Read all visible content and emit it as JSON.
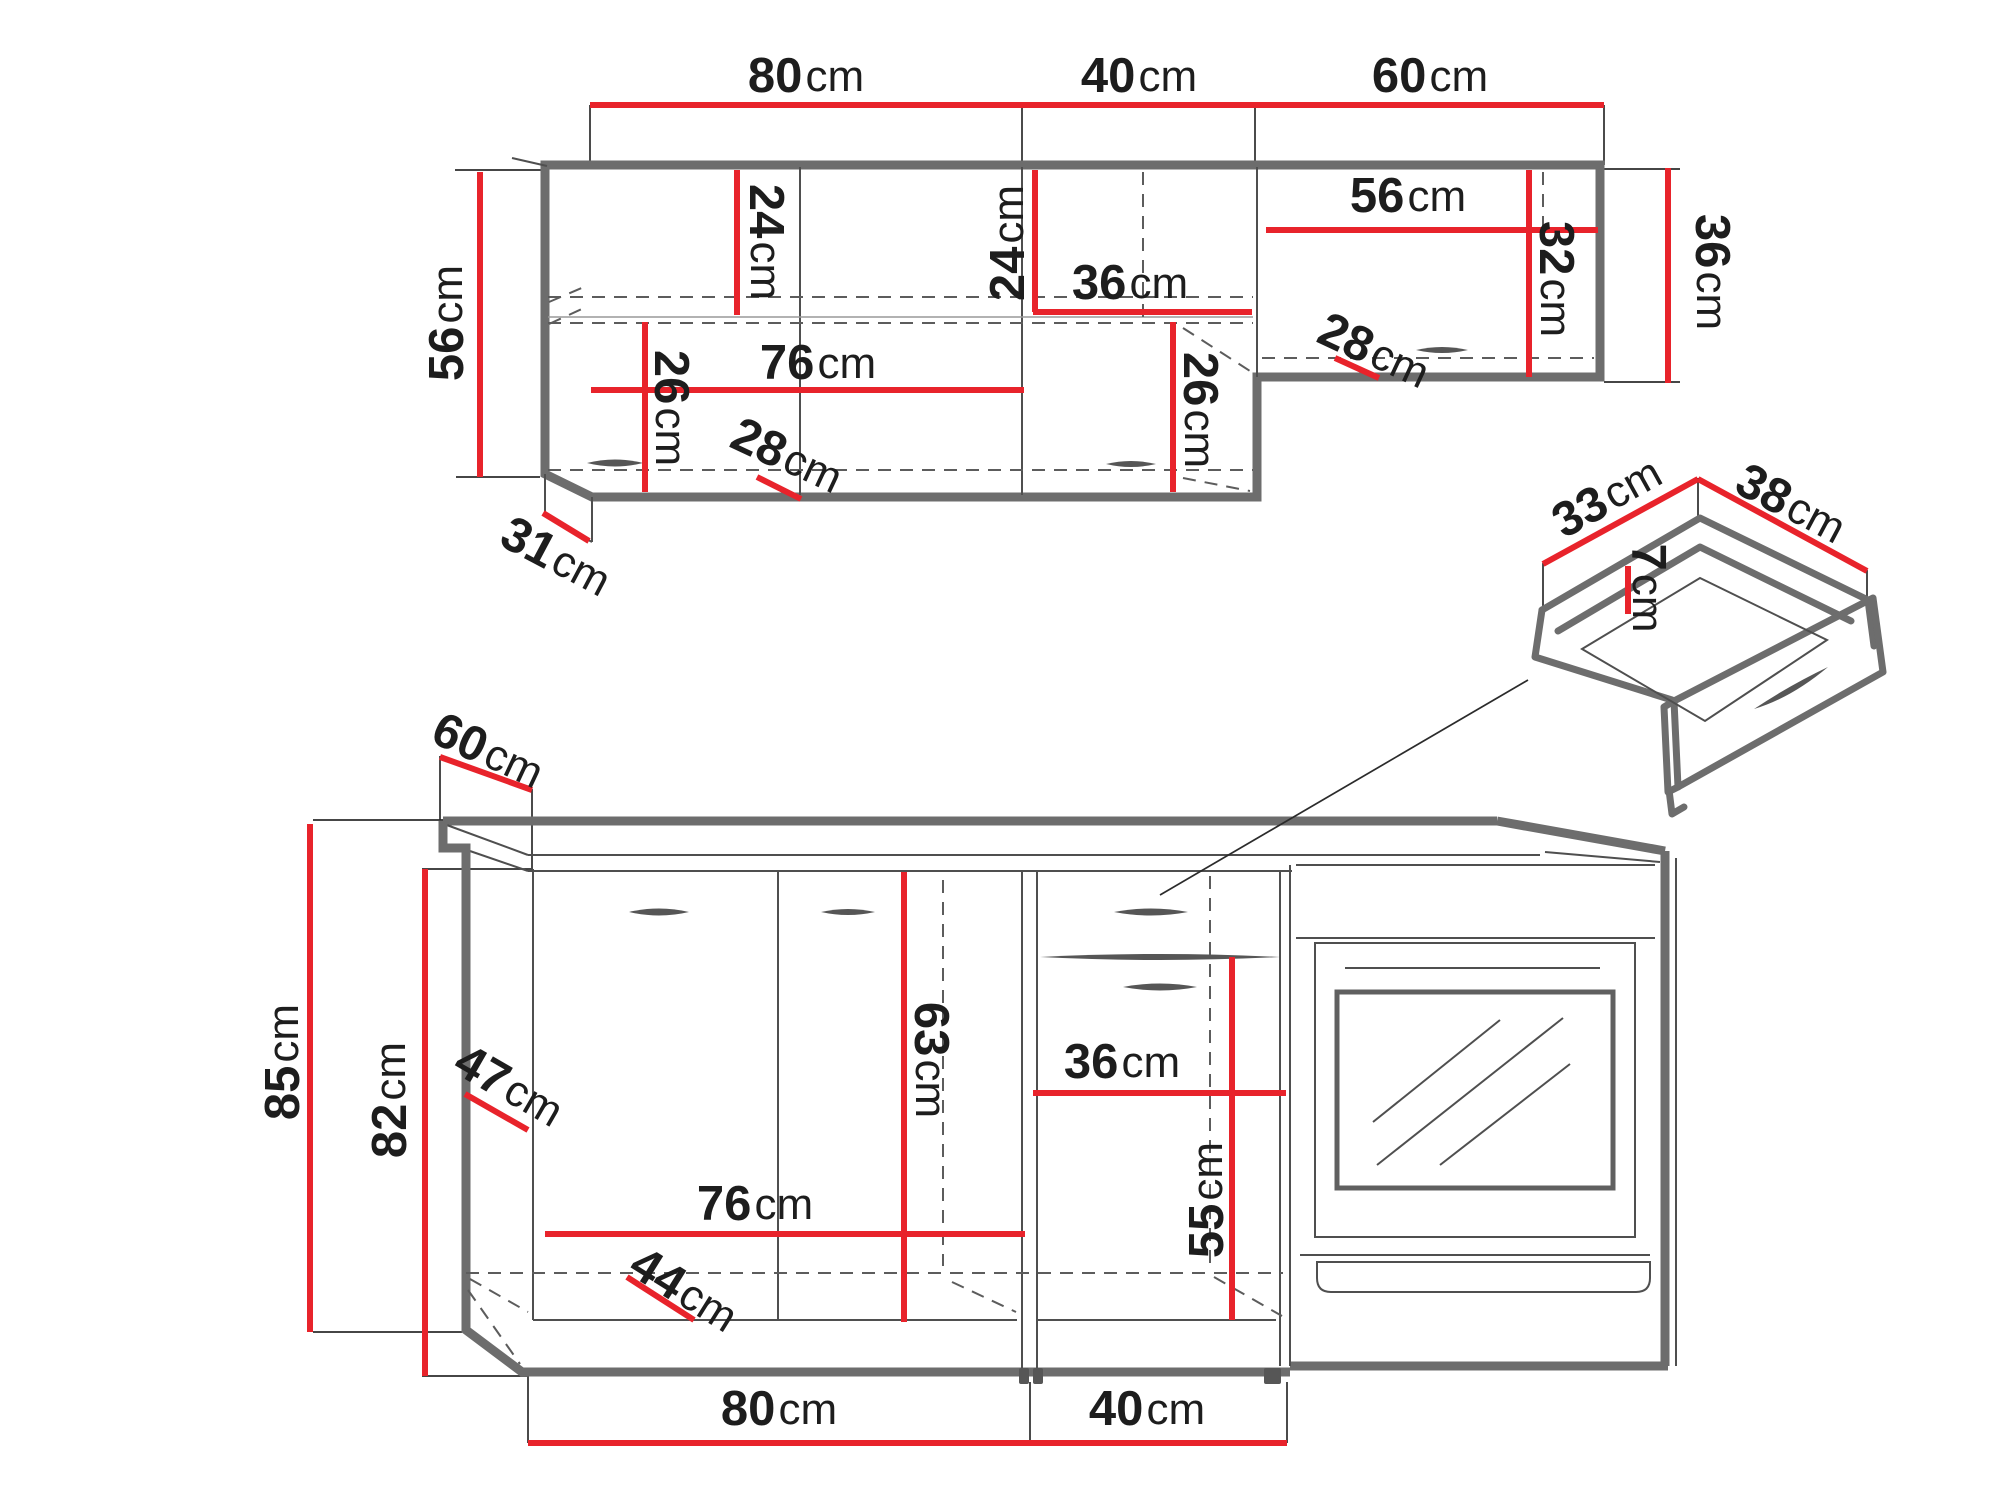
{
  "diagram": {
    "kind": "kitchen-furniture-dimension-drawing",
    "views": [
      "upper-wall-cabinets",
      "base-cabinets-with-oven",
      "drawer-box-detail"
    ]
  },
  "colors": {
    "dimension_red": "#e8232b",
    "outline_gray": "#6d6d6d",
    "line_dark": "#4f4f4f",
    "text": "#1d1d1d",
    "background": "#ffffff"
  },
  "labels": {
    "top_w_80": {
      "num": "80",
      "unit": "cm"
    },
    "top_w_40": {
      "num": "40",
      "unit": "cm"
    },
    "top_w_60": {
      "num": "60",
      "unit": "cm"
    },
    "top_h_right_36": {
      "num": "36",
      "unit": "cm"
    },
    "top_h_left_56": {
      "num": "56",
      "unit": "cm"
    },
    "top_int_24_a": {
      "num": "24",
      "unit": "cm"
    },
    "top_int_24_b": {
      "num": "24",
      "unit": "cm"
    },
    "top_int_36": {
      "num": "36",
      "unit": "cm"
    },
    "top_int_56": {
      "num": "56",
      "unit": "cm"
    },
    "top_int_32": {
      "num": "32",
      "unit": "cm"
    },
    "top_int_26_a": {
      "num": "26",
      "unit": "cm"
    },
    "top_int_76": {
      "num": "76",
      "unit": "cm"
    },
    "top_int_26_b": {
      "num": "26",
      "unit": "cm"
    },
    "top_int_28_a": {
      "num": "28",
      "unit": "cm"
    },
    "top_int_28_b": {
      "num": "28",
      "unit": "cm"
    },
    "top_depth_31": {
      "num": "31",
      "unit": "cm"
    },
    "base_depth_60": {
      "num": "60",
      "unit": "cm"
    },
    "base_h_85": {
      "num": "85",
      "unit": "cm"
    },
    "base_h_82": {
      "num": "82",
      "unit": "cm"
    },
    "base_int_47": {
      "num": "47",
      "unit": "cm"
    },
    "base_int_63": {
      "num": "63",
      "unit": "cm"
    },
    "base_int_36": {
      "num": "36",
      "unit": "cm"
    },
    "base_int_55": {
      "num": "55",
      "unit": "cm"
    },
    "base_int_76": {
      "num": "76",
      "unit": "cm"
    },
    "base_int_44": {
      "num": "44",
      "unit": "cm"
    },
    "base_w_80": {
      "num": "80",
      "unit": "cm"
    },
    "base_w_40": {
      "num": "40",
      "unit": "cm"
    },
    "drawer_33": {
      "num": "33",
      "unit": "cm"
    },
    "drawer_38": {
      "num": "38",
      "unit": "cm"
    },
    "drawer_7": {
      "num": "7",
      "unit": "cm"
    }
  }
}
